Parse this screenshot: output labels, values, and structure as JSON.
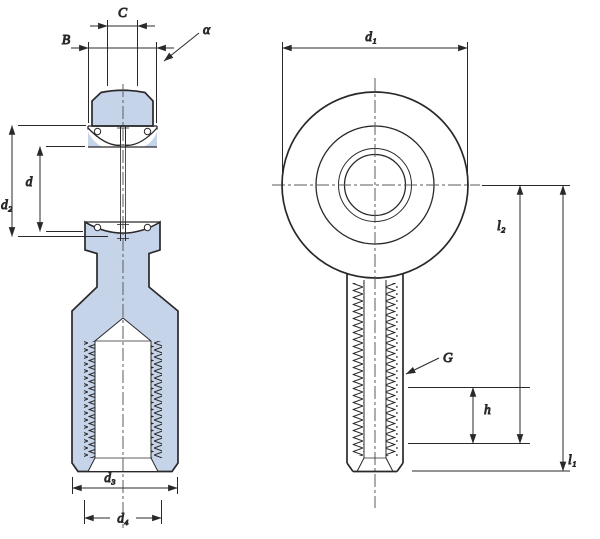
{
  "drawing_title": "Rod end with female thread - dimension drawing",
  "colors": {
    "ink": "#2a282b",
    "part_fill": "#c6d4e9",
    "background": "#ffffff",
    "centerline": "#5c5a5e"
  },
  "views": {
    "section": {
      "name": "front section view"
    },
    "side": {
      "name": "side view"
    }
  },
  "labels": {
    "width_inner": "C",
    "width_outer": "B",
    "tilt_angle": "α",
    "bore": "d",
    "sphere_dia": "d₂",
    "shank_dia": "d₃",
    "thread_od": "d₄",
    "head_dia": "d₁",
    "thread": "G",
    "center_to_thread": "l₂",
    "thread_length": "h",
    "total_length": "l₁"
  }
}
